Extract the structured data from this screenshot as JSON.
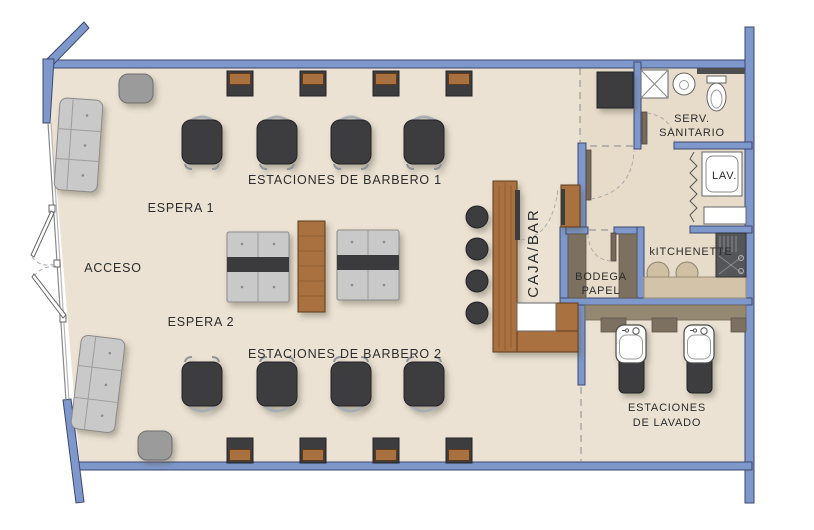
{
  "plan": {
    "type": "floor-plan",
    "subject": "barbershop layout",
    "labels": {
      "barber_stations_1": "ESTACIONES DE BARBERO 1",
      "espera_1": "ESPERA 1",
      "acceso": "ACCESO",
      "espera_2": "ESPERA 2",
      "barber_stations_2": "ESTACIONES DE BARBERO 2",
      "caja_bar": "CAJA/BAR",
      "bodega": {
        "line1": "BODEGA",
        "line2": "PAPEL"
      },
      "sanitario": {
        "line1": "SERV.",
        "line2": "SANITARIO"
      },
      "lav": "LAV.",
      "kitchenette": "kITCHENETTE",
      "lavado": {
        "line1": "ESTACIONES",
        "line2": "DE LAVADO"
      }
    },
    "furniture_counts": {
      "barber_chairs": 8,
      "mirror_stations": 8,
      "waiting_sofas": 2,
      "waiting_benches": 2,
      "side_tables": 2,
      "bar_stools": 4,
      "wash_stations": 2,
      "kitchenette_stools": 2
    },
    "colors": {
      "wall": "#7e98cc",
      "wall_outline": "#3c486e",
      "floor": "#ebe2d3",
      "back_floor": "#e7dcca",
      "wood": "#a9713f",
      "dark_furniture": "#3d3d3f",
      "sofa_gray": "#c9c9c9",
      "table_gray": "#9b9b9b",
      "taupe_counter": "#958873",
      "kitchen_counter": "#d2c3a9",
      "text": "#2c2c2c"
    }
  }
}
